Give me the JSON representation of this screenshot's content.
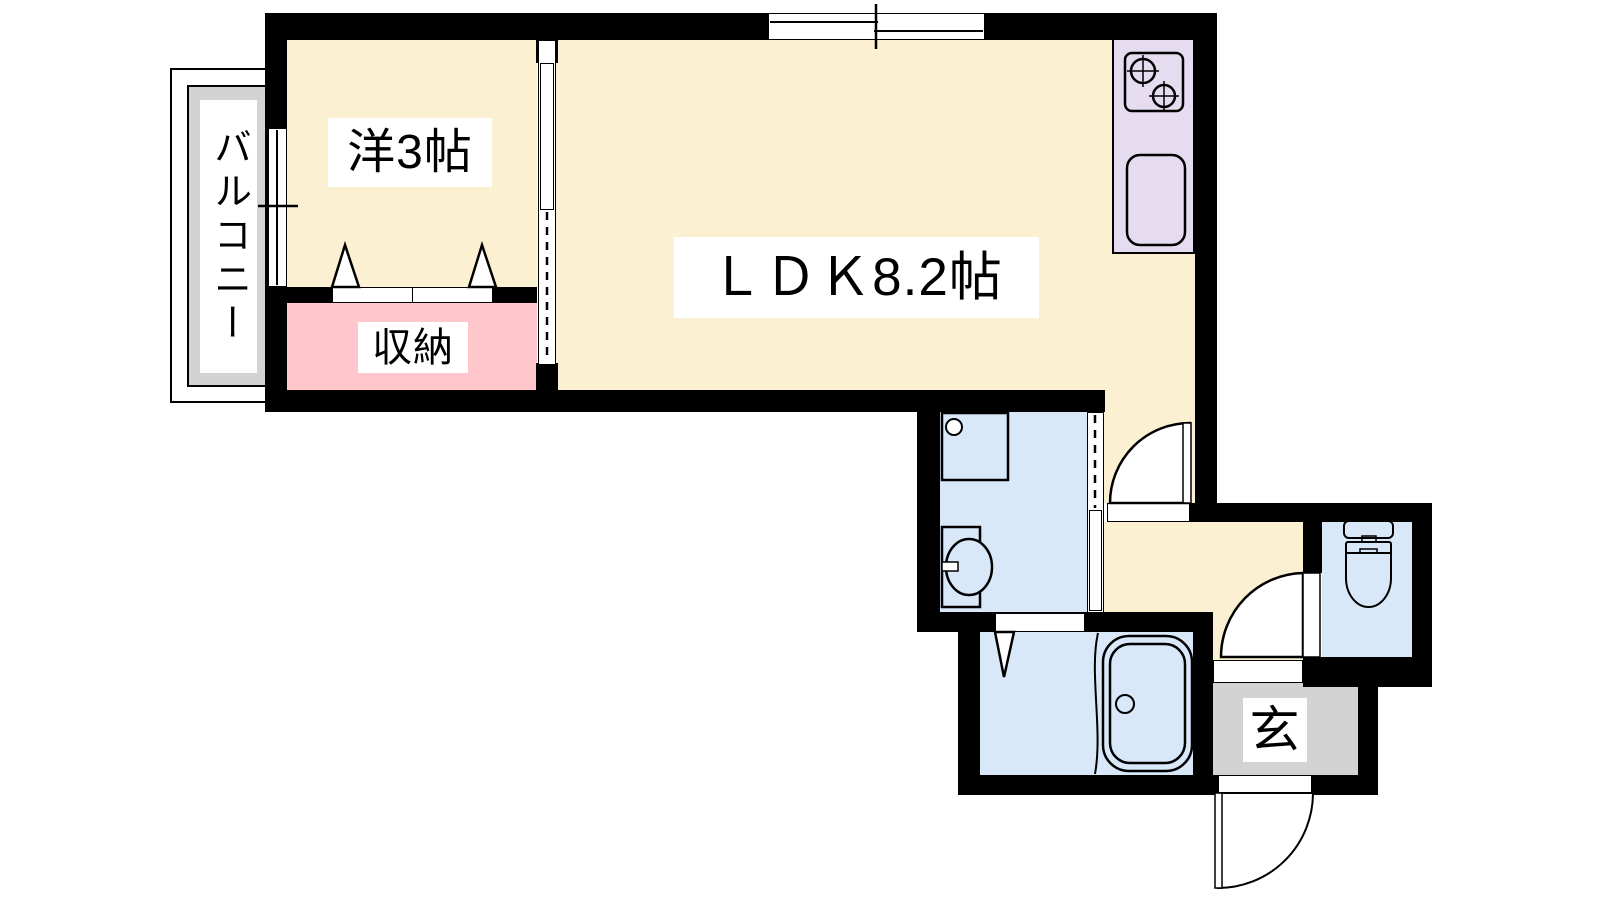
{
  "plan": {
    "type": "apartment-floor-plan",
    "rooms": {
      "balcony": {
        "label": "バルコニー"
      },
      "western": {
        "label": "洋3帖"
      },
      "ldk": {
        "label": "ＬＤＫ8.2帖"
      },
      "storage": {
        "label": "収納"
      },
      "entrance": {
        "label": "玄"
      }
    },
    "colors": {
      "room_floor": "#FCF0D2",
      "storage": "#FFC7CC",
      "kitchen_counter": "#E6DCF0",
      "wet_area": "#D9E8F8",
      "gray_area": "#D3D3D3",
      "wall": "#000000"
    },
    "fixtures": [
      "gas-stove-2-burner",
      "kitchen-sink",
      "washing-machine-pan",
      "vanity-sink",
      "bathtub",
      "toilet"
    ],
    "openings": [
      "sliding-window-top",
      "sliding-window-west",
      "closet-double-doors",
      "room-sliding-door",
      "washroom-sliding-door",
      "ldk-hall-hinged-door",
      "bath-folding-door",
      "toilet-hinged-door",
      "entrance-hinged-door"
    ]
  }
}
